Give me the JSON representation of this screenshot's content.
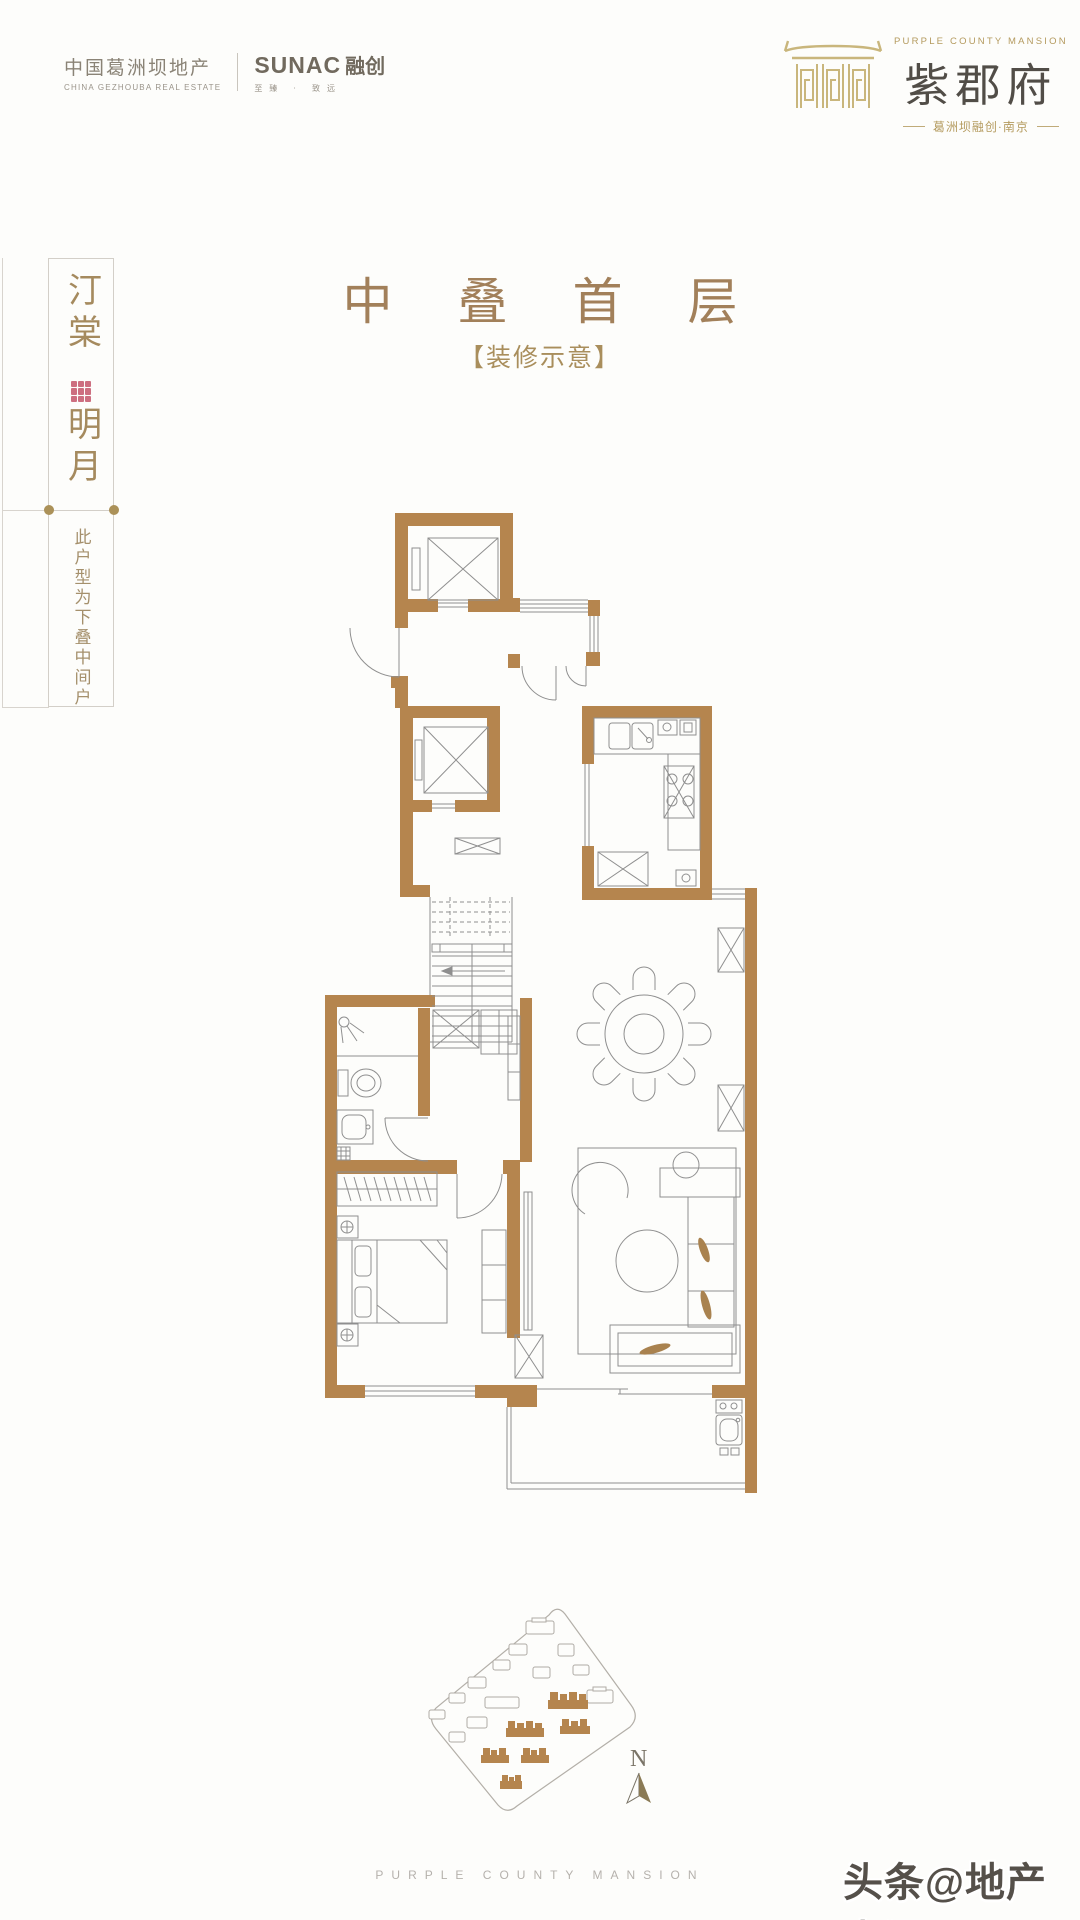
{
  "colors": {
    "brand_gold": "#b49a5e",
    "wall_tan": "#b5854e",
    "title_bronze": "#a2805a",
    "name_dark": "#514d47",
    "plan_line": "#8f8f8f",
    "seal_red": "#c4566a",
    "muted_gray": "#8d8579",
    "footer_gray": "#b5b1ac"
  },
  "header": {
    "left_brand": {
      "cn": "中国葛洲坝地产",
      "en": "CHINA GEZHOUBA REAL ESTATE",
      "partner_latin": "SUNAC",
      "partner_cn": "融创",
      "partner_slogan": "至臻 · 致远"
    },
    "right_brand": {
      "en": "PURPLE COUNTY MANSION",
      "cn": "紫郡府",
      "sub": "葛洲坝融创·南京"
    }
  },
  "sidebar": {
    "name_top": "汀棠",
    "name_bottom": "明月",
    "note": "此户型为下叠中间户"
  },
  "title": {
    "main": "中叠首层",
    "sub": "【装修示意】"
  },
  "floorplan": {
    "compass_label": "N"
  },
  "footer": {
    "en": "PURPLE COUNTY MANSION"
  },
  "watermark": {
    "text": "头条@地产点评"
  }
}
